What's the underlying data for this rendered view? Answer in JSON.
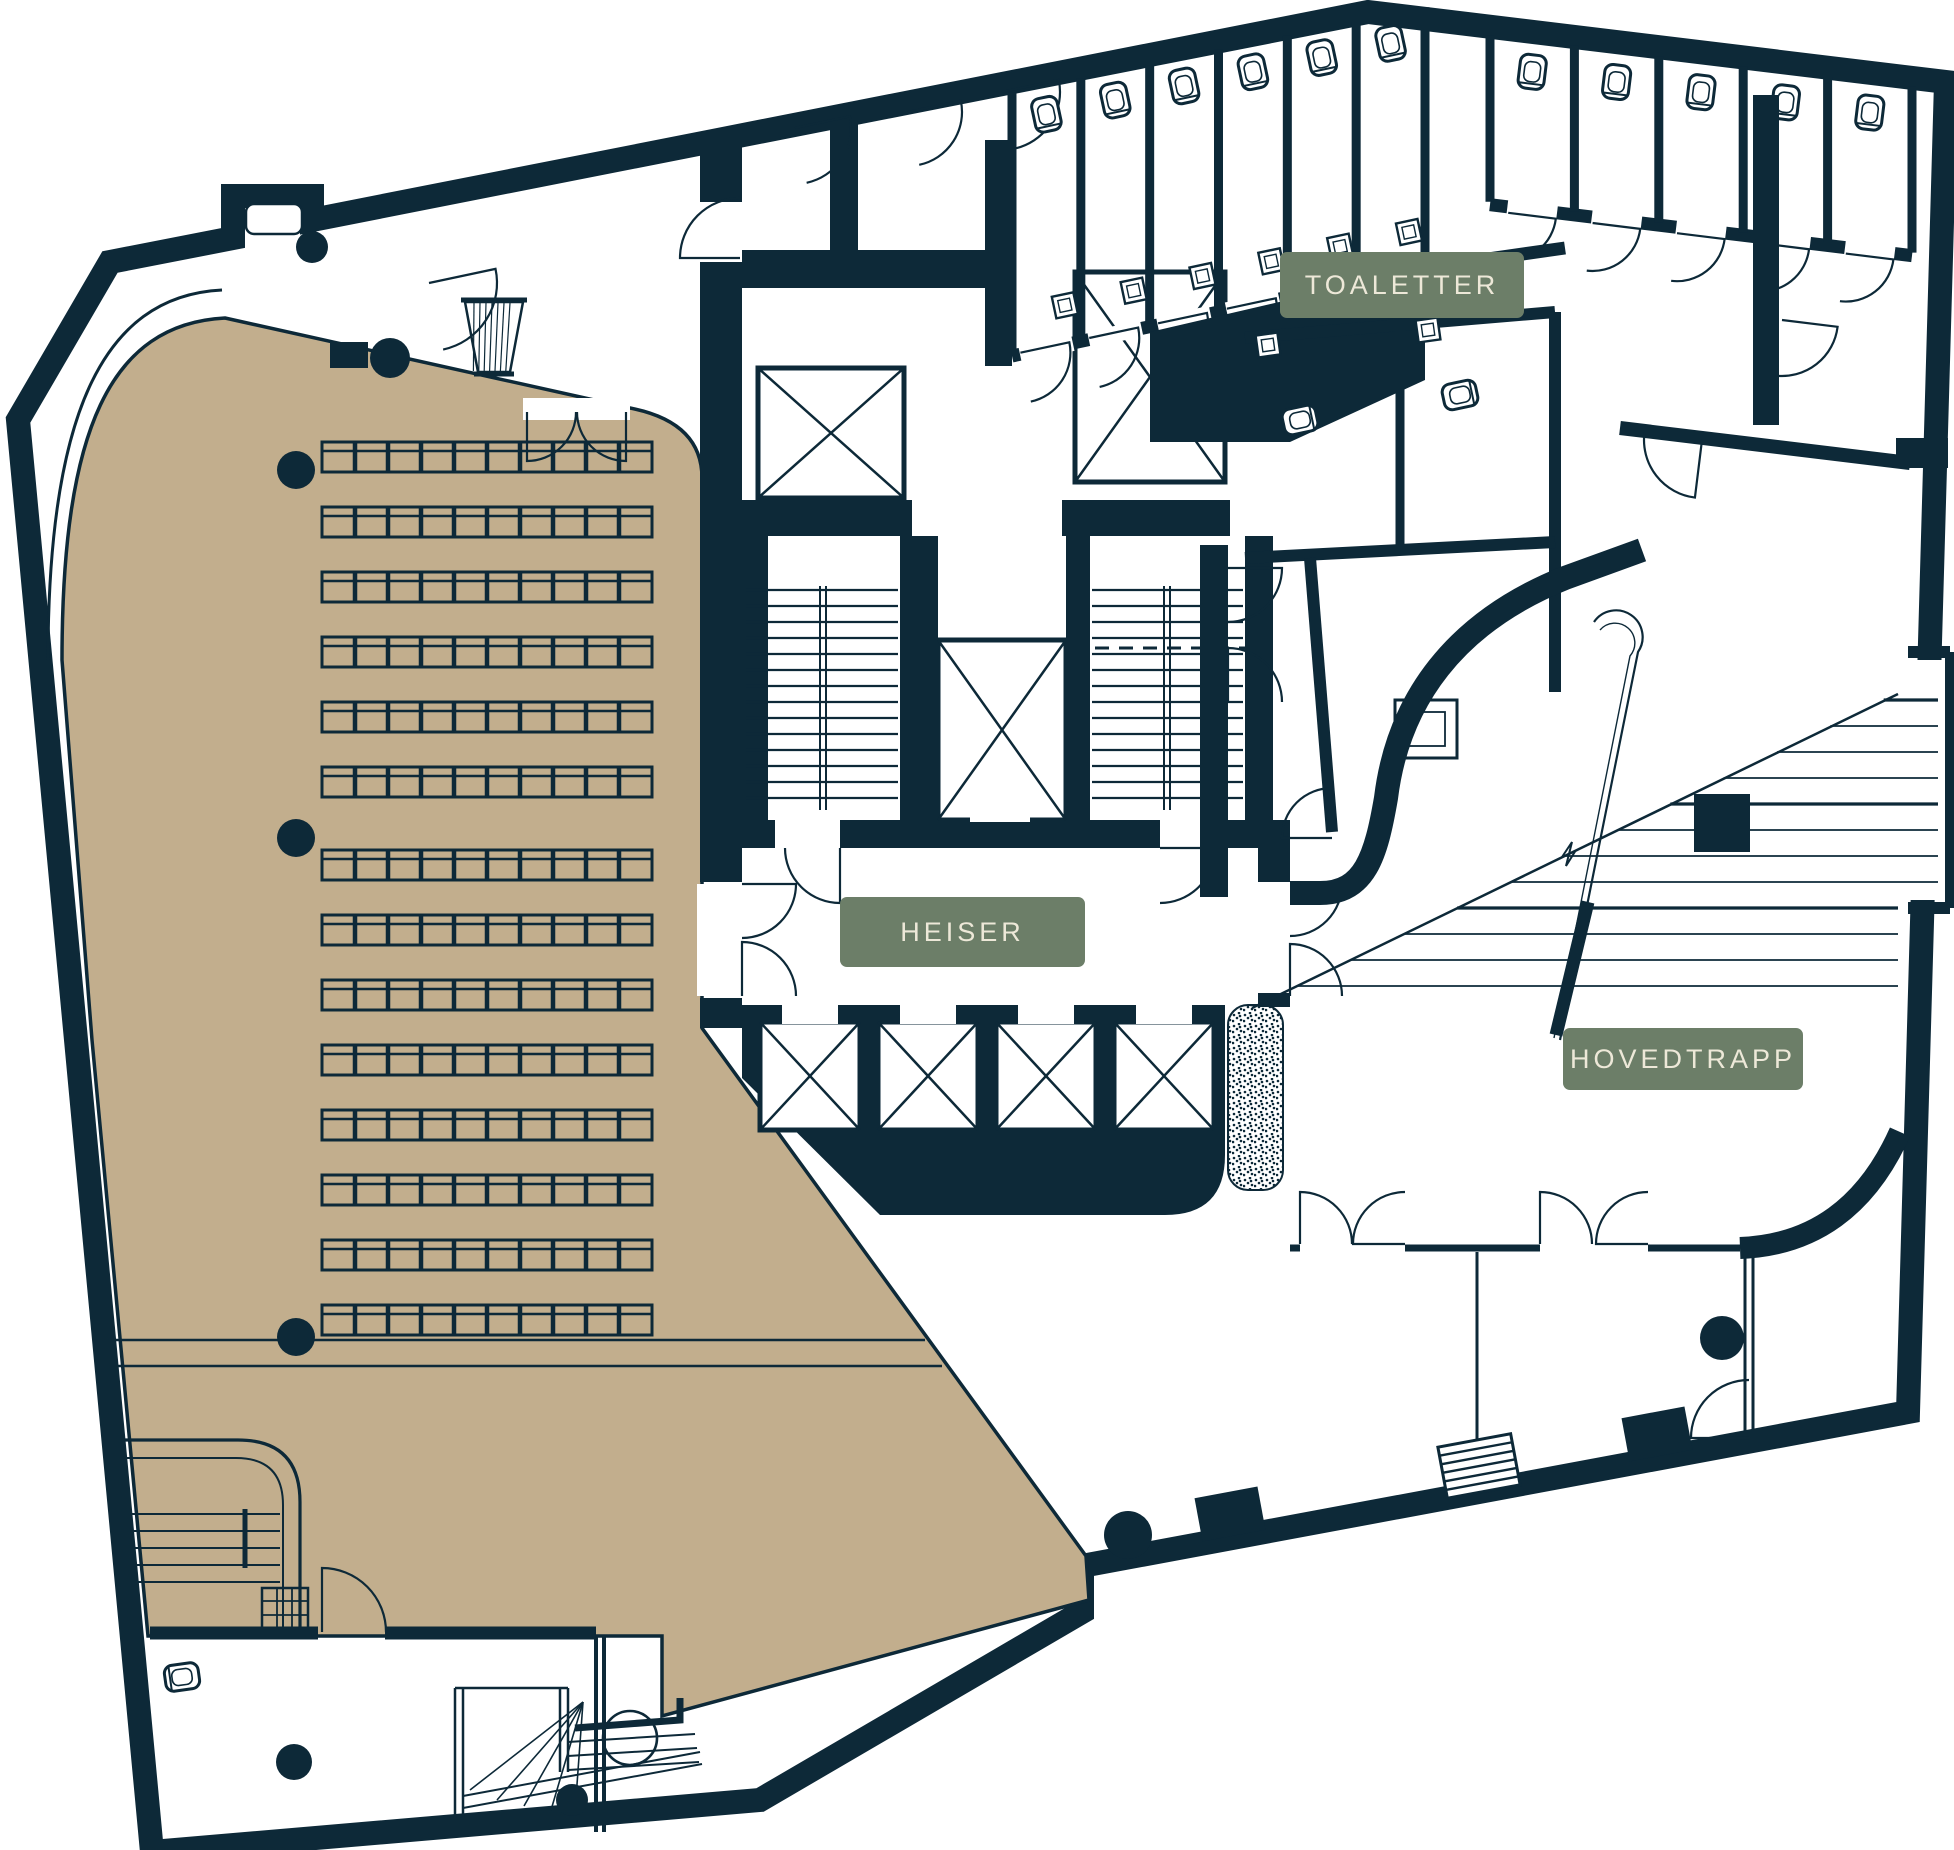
{
  "plan": {
    "labels": {
      "toaletter": "TOALETTER",
      "heiser": "HEISER",
      "hovedtrapp": "HOVEDTRAPP"
    },
    "colors": {
      "wall": "#0D2938",
      "floor": "#FFFFFF",
      "auditorium_fill": "#C2AE8D",
      "badge_bg": "#6C7E68",
      "badge_text": "#EDE8D8"
    },
    "auditorium": {
      "seat_rows_front": 6,
      "seat_rows_back": 8,
      "seats_per_row": 10,
      "columns": 3
    },
    "core": {
      "elevator_bank_shafts": 4,
      "single_elevator_shafts": 3,
      "stair_flights": 2
    },
    "toilets": {
      "top_row_stalls": 6,
      "right_row_stalls": 5,
      "accessible_rooms": 3
    },
    "main_stair_treads": 12
  }
}
